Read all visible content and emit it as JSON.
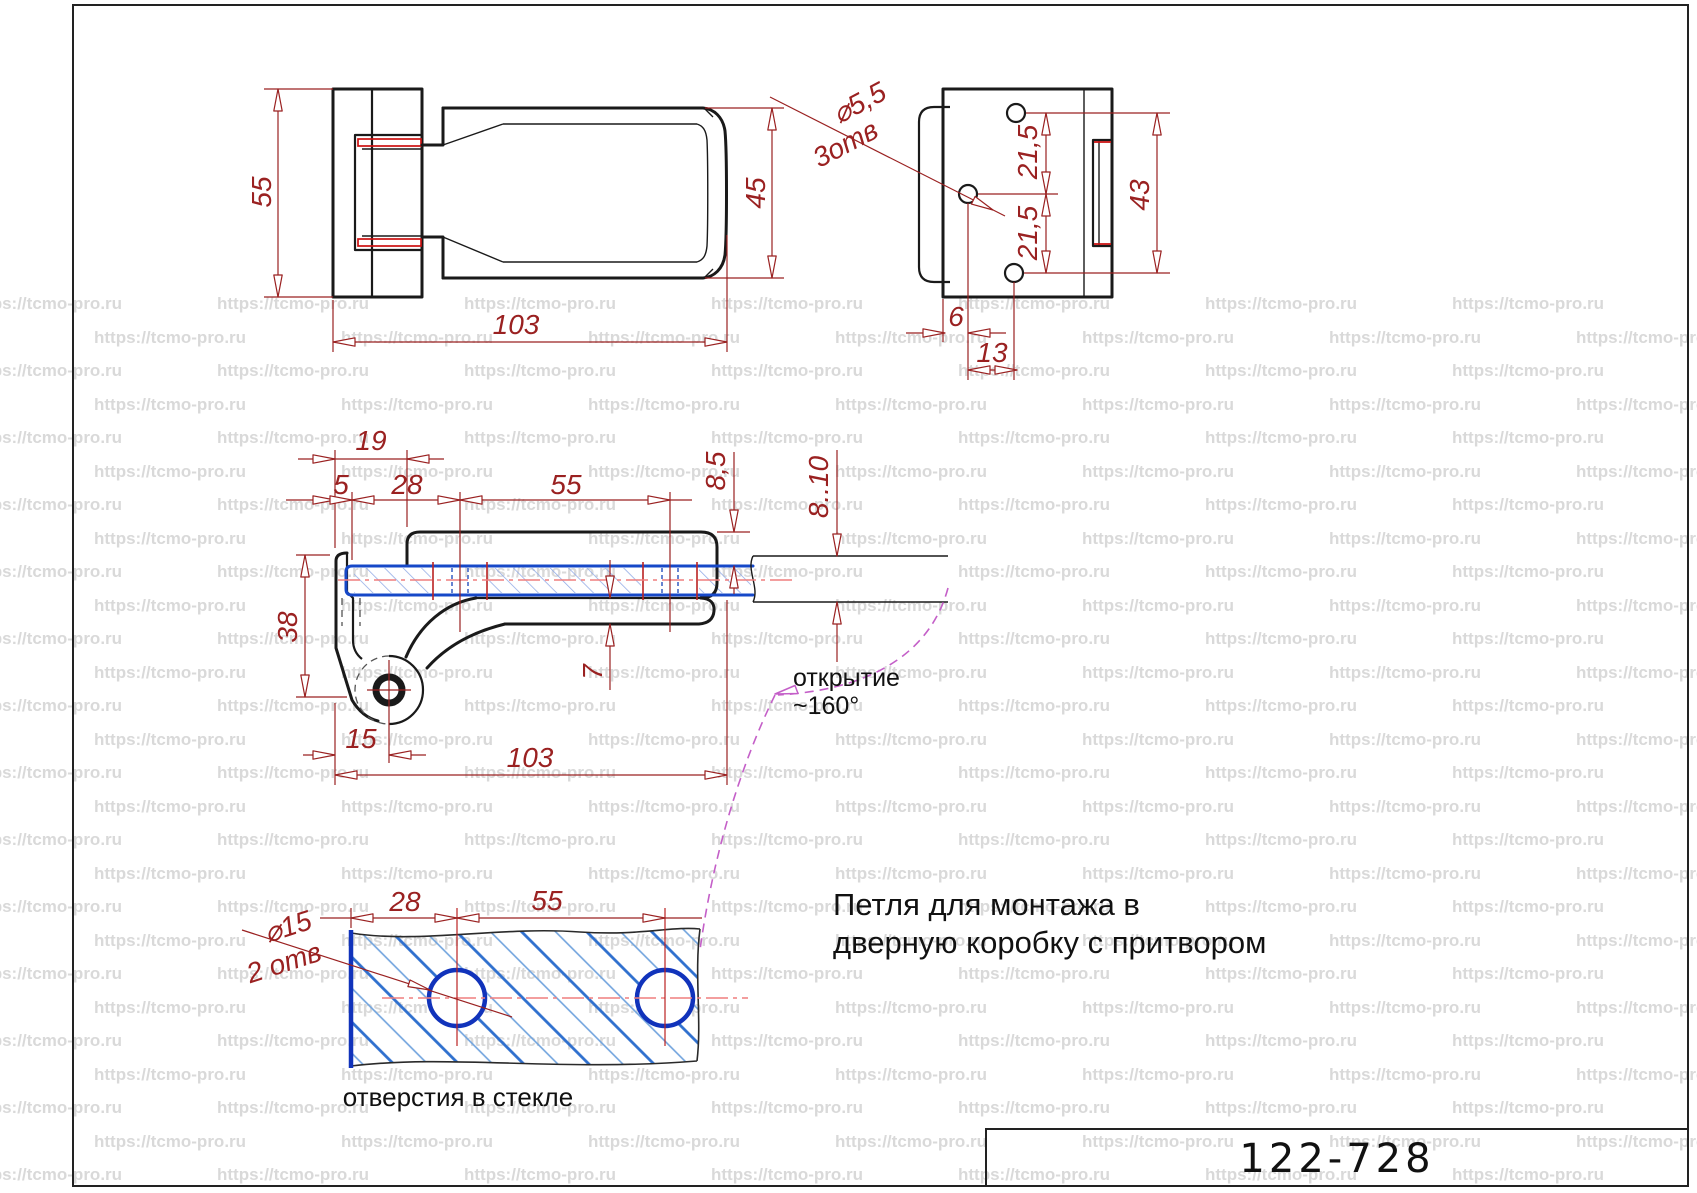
{
  "watermark": {
    "text": "https://tcmo-pro.ru"
  },
  "title_block": {
    "part_number": "122-728"
  },
  "description": {
    "line1": "Петля для монтажа в",
    "line2": "дверную коробку с притвором"
  },
  "plan_view": {
    "dim_height": "55",
    "dim_length": "103",
    "dim_leaf_width": "45"
  },
  "back_view": {
    "hole_dia": "⌀5,5",
    "hole_count": "3отв",
    "pitch_top": "21,5",
    "pitch_bottom": "21,5",
    "dim_span": "43",
    "dim_offset_x": "6",
    "dim_offset_y": "13"
  },
  "section_view": {
    "dim_19": "19",
    "dim_5": "5",
    "dim_28": "28",
    "dim_55": "55",
    "dim_clamp_thickness": "8,5",
    "dim_glass_thickness": "8..10",
    "dim_38": "38",
    "dim_7": "7",
    "dim_15": "15",
    "dim_length": "103",
    "opening_label": "открытие",
    "opening_angle": "~160°"
  },
  "glass_view": {
    "hole_dia": "⌀15",
    "hole_count": "2 отв",
    "dim_28": "28",
    "dim_55": "55",
    "caption": "отверстия в стекле"
  },
  "colors": {
    "dimension_red": "#9a2121",
    "accent_red": "#cc1111",
    "glass_blue": "#1648c8",
    "hatch_blue": "#8fa9e6",
    "centerline_pink": "#ef7f7f",
    "opening_magenta": "#c45fc8",
    "watermark_gray": "#d9d9d9",
    "line_black": "#1a1a1a"
  }
}
